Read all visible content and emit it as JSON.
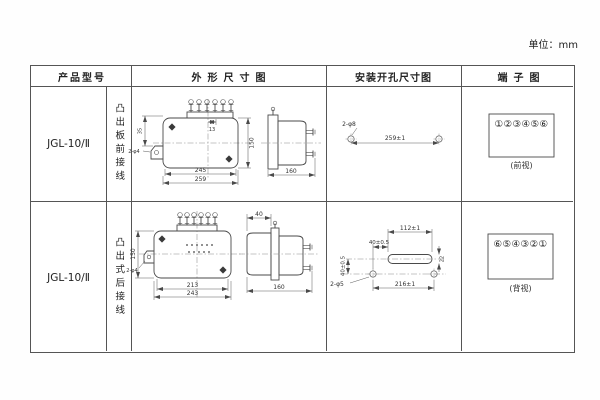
{
  "unit_label": "单位：mm",
  "colors": {
    "ink": "#4a4a4a",
    "table_border": "#555555",
    "text": "#222222"
  },
  "table": {
    "headers": {
      "model": "产品型号",
      "outline": "外形尺寸图",
      "install": "安装开孔尺寸图",
      "terminal": "端子图"
    },
    "rows": [
      {
        "model": "JGL-10/Ⅱ",
        "wiring": "凸出板前接线",
        "outline": {
          "width_inner": "245",
          "width_outer": "259",
          "height": "150",
          "terminal_pitch": "13",
          "bracket_holes": "2-φ4",
          "bracket_drop": "35",
          "depth": "160"
        },
        "install": {
          "holes": "2-φ8",
          "spacing": "259±1"
        },
        "terminal": {
          "numbers": "①②③④⑤⑥",
          "view": "(前视)"
        }
      },
      {
        "model": "JGL-10/Ⅱ",
        "wiring": "凸出式后接线",
        "outline": {
          "width_inner": "213",
          "width_outer": "243",
          "height": "150",
          "bracket_holes": "2-φ4",
          "protrusion": "40",
          "depth": "160"
        },
        "install": {
          "slot_width": "112±1",
          "slot_offset": "40±0.5",
          "rise": "40±0.5",
          "slot_height": "22",
          "holes": "2-φ5",
          "spacing": "216±1"
        },
        "terminal": {
          "numbers": "⑥⑤④③②①",
          "view": "(背视)"
        }
      }
    ]
  }
}
